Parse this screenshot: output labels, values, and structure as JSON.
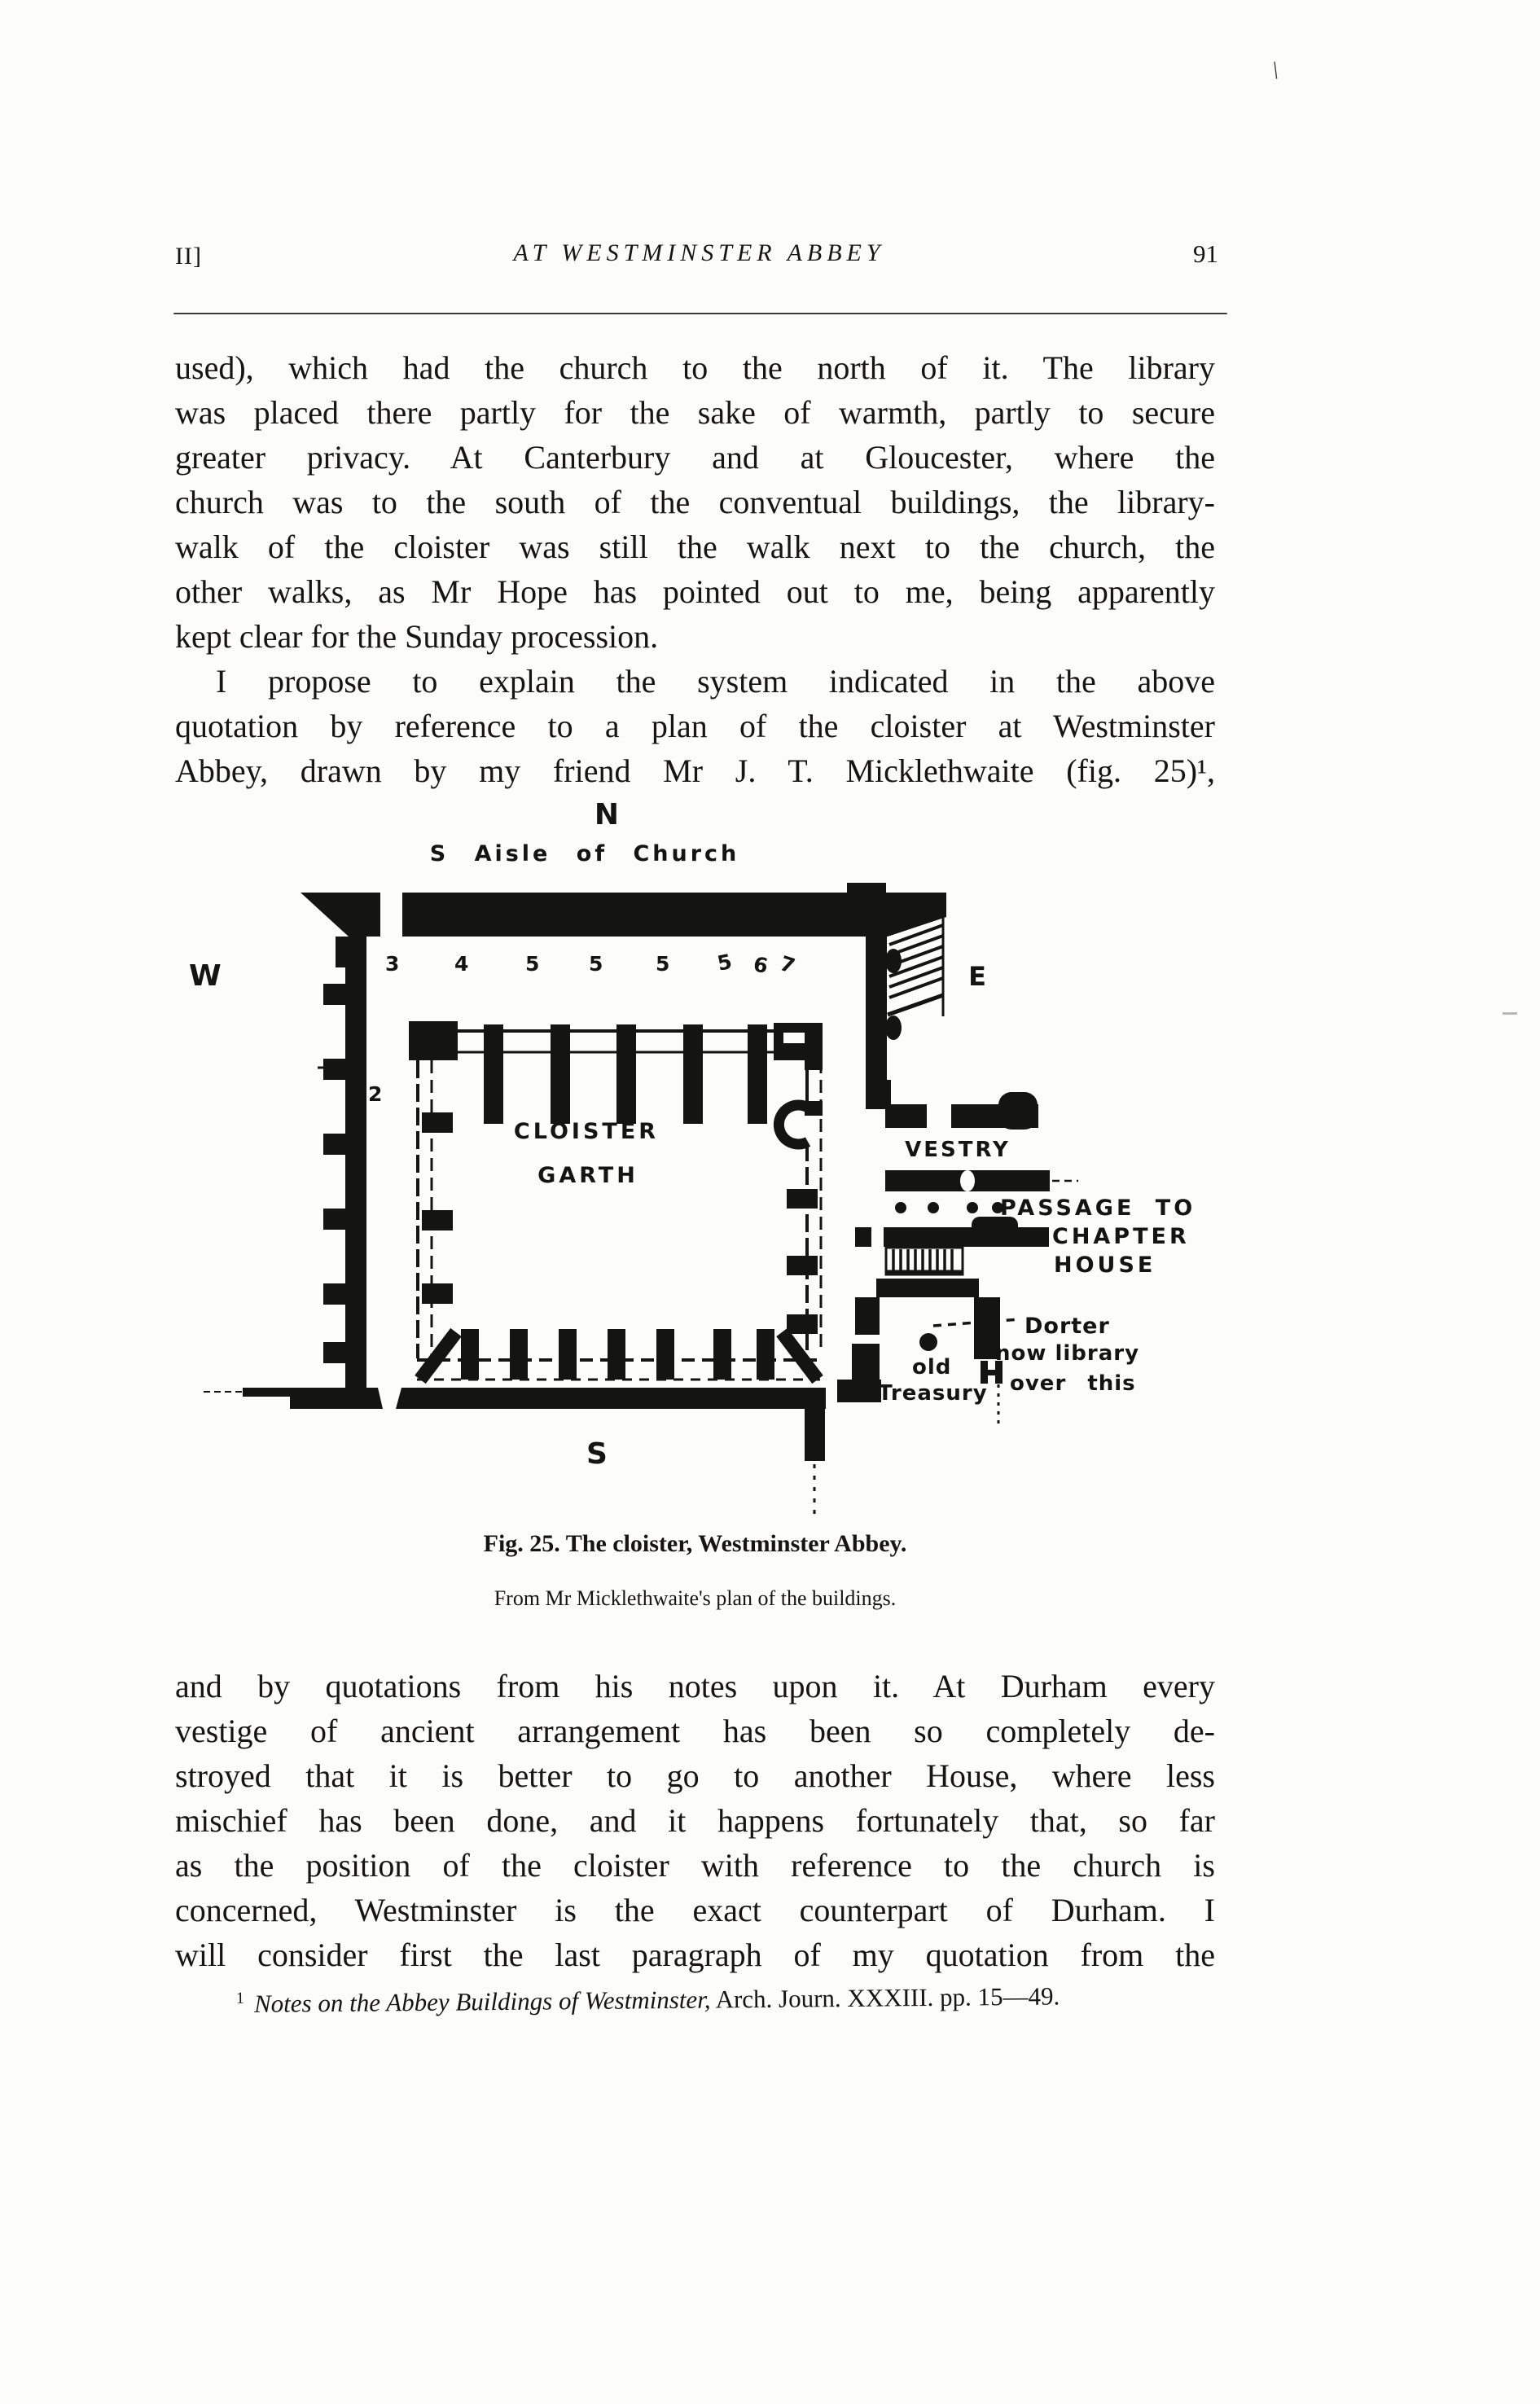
{
  "header": {
    "section": "II]",
    "title": "AT WESTMINSTER ABBEY",
    "page_number": "91"
  },
  "body": {
    "para1": [
      "used), which had the church to the north of it.  The library",
      "was placed there partly for the sake of warmth, partly to secure",
      "greater privacy.  At Canterbury and at Gloucester, where the",
      "church was to the south of the conventual buildings, the library-",
      "walk of the cloister was still the walk next to the church, the",
      "other walks, as Mr Hope has pointed out to me, being apparently",
      "kept clear for the Sunday procession."
    ],
    "para2": [
      "I propose to explain the system indicated in the above",
      "quotation by reference to a plan of the cloister at Westminster",
      "Abbey, drawn by my friend Mr J. T. Micklethwaite (fig. 25)¹,"
    ],
    "para3": [
      "and by quotations from his notes upon it.  At Durham every",
      "vestige of ancient arrangement has been so completely de-",
      "stroyed that it is better to go to another House, where less",
      "mischief has been done, and it happens fortunately that, so far",
      "as the position of the cloister with reference to the church is",
      "concerned, Westminster is the exact counterpart of Durham.  I",
      "will consider first the last paragraph of my quotation from the"
    ],
    "footnote": {
      "marker": "1",
      "title_italic": "Notes on the Abbey Buildings of Westminster,",
      "rest": " Arch. Journ. XXXIII. pp. 15—49."
    }
  },
  "figure": {
    "caption": "Fig. 25.  The cloister, Westminster Abbey.",
    "credit": "From Mr Micklethwaite's plan of the buildings.",
    "labels": {
      "north": "N",
      "aisle": "S Aisle of Church",
      "west": "W",
      "east": "E",
      "south": "S",
      "garth_line1": "CLOISTER",
      "garth_line2": "GARTH",
      "vestry": "VESTRY",
      "passage_line1": "PASSAGE TO",
      "passage_line2": "CHAPTER",
      "passage_line3": "HOUSE",
      "dorter": "Dorter",
      "dorter_note1": "now library",
      "dorter_note2": "over this",
      "treasury_line1": "old",
      "treasury_line2": "Treasury",
      "west_bay_number": "2",
      "bay_numbers": [
        "3",
        "4",
        "5",
        "5",
        "5",
        "5",
        "6",
        "7"
      ]
    }
  },
  "artifacts": {
    "top_right_mark": "\\"
  }
}
